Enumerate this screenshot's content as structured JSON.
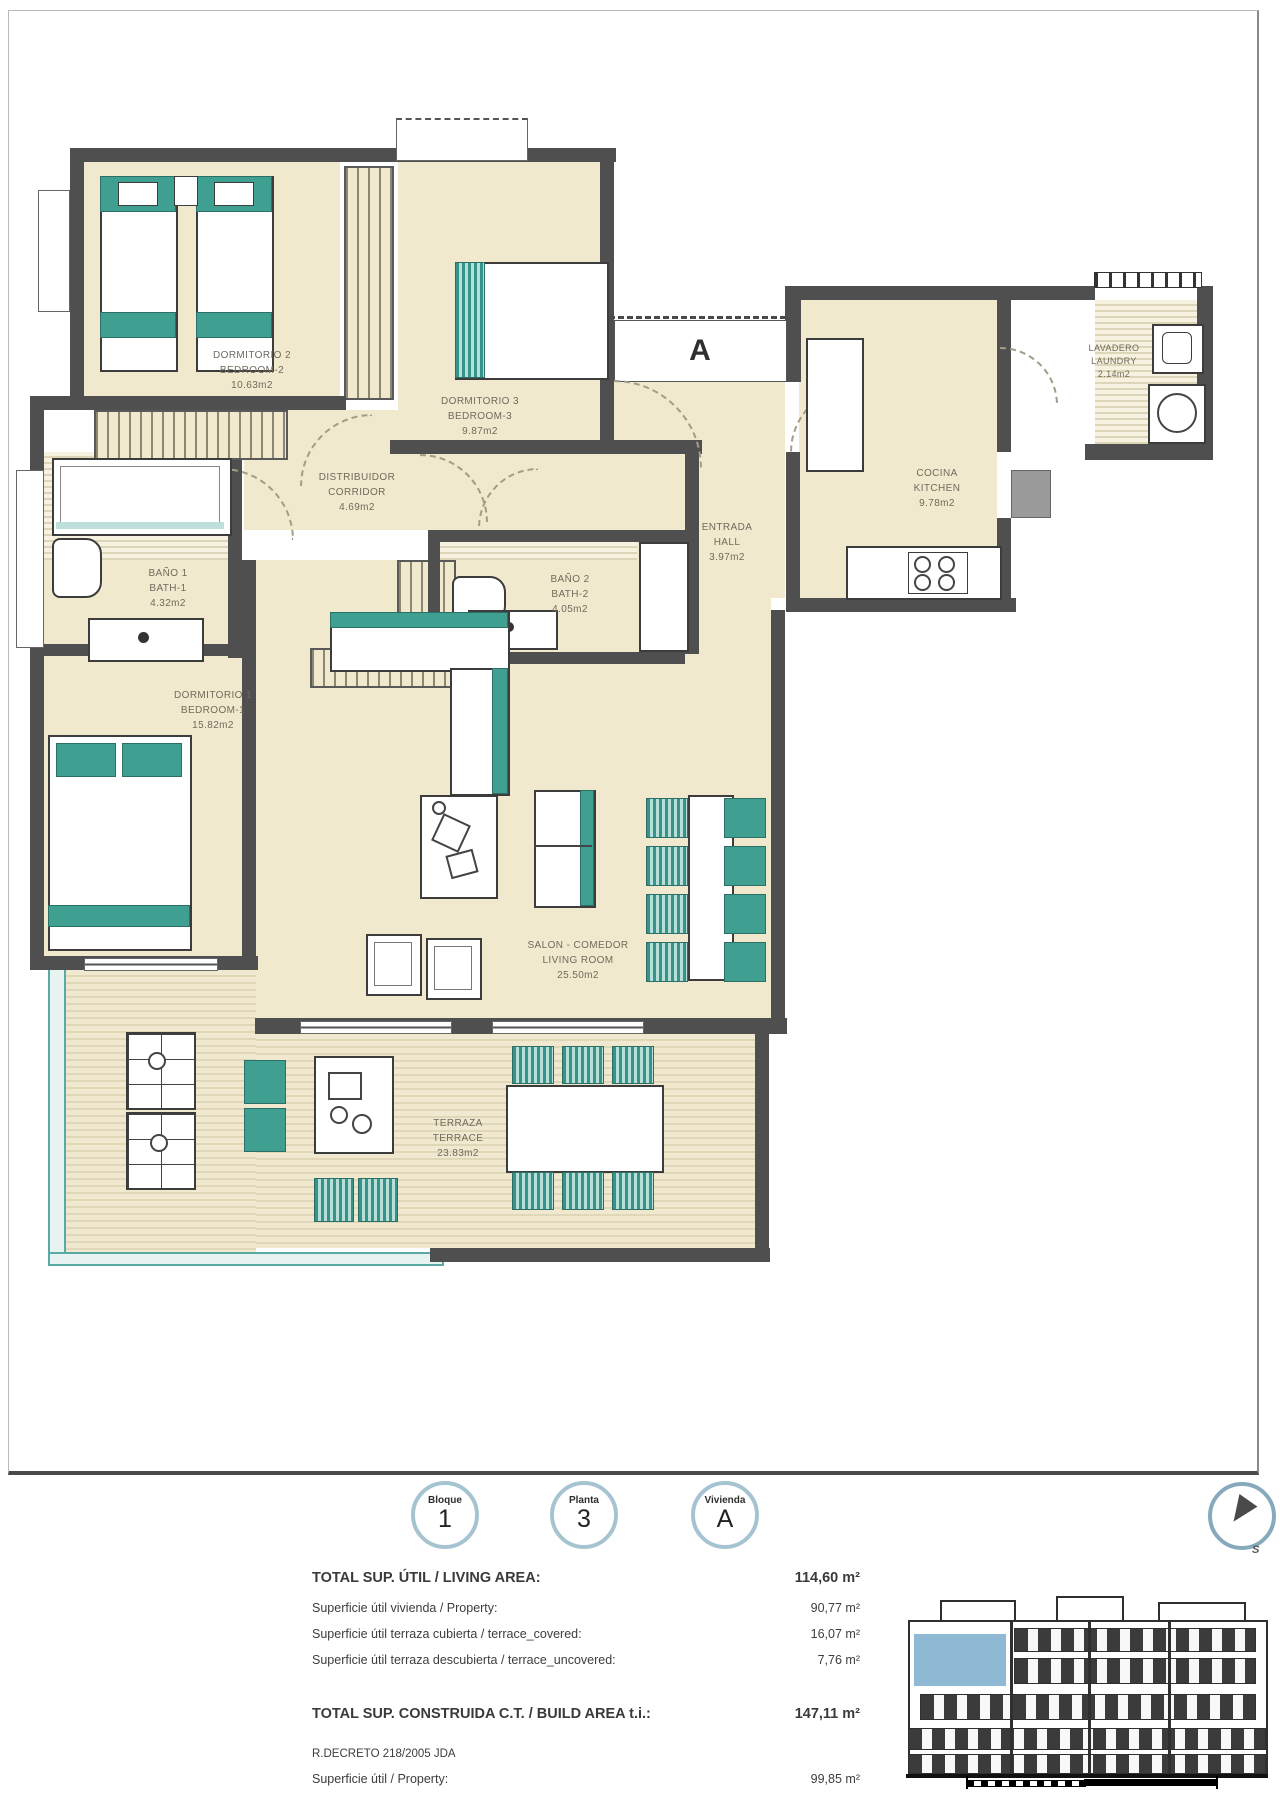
{
  "plan": {
    "entrance_label": "A",
    "rooms": [
      {
        "id": "bedroom2",
        "name_es": "DORMITORIO 2",
        "name_en": "BEDROOM-2",
        "area": "10.63m2"
      },
      {
        "id": "bedroom3",
        "name_es": "DORMITORIO 3",
        "name_en": "BEDROOM-3",
        "area": "9.87m2"
      },
      {
        "id": "corridor",
        "name_es": "DISTRIBUIDOR",
        "name_en": "CORRIDOR",
        "area": "4.69m2"
      },
      {
        "id": "hall",
        "name_es": "ENTRADA",
        "name_en": "HALL",
        "area": "3.97m2"
      },
      {
        "id": "kitchen",
        "name_es": "COCINA",
        "name_en": "KITCHEN",
        "area": "9.78m2"
      },
      {
        "id": "laundry",
        "name_es": "LAVADERO",
        "name_en": "LAUNDRY",
        "area": "2.14m2"
      },
      {
        "id": "bath1",
        "name_es": "BAÑO 1",
        "name_en": "BATH-1",
        "area": "4.32m2"
      },
      {
        "id": "bath2",
        "name_es": "BAÑO 2",
        "name_en": "BATH-2",
        "area": "4.05m2"
      },
      {
        "id": "bedroom1",
        "name_es": "DORMITORIO 1",
        "name_en": "BEDROOM-1",
        "area": "15.82m2"
      },
      {
        "id": "living",
        "name_es": "SALON - COMEDOR",
        "name_en": "LIVING ROOM",
        "area": "25.50m2"
      },
      {
        "id": "terrace",
        "name_es": "TERRAZA",
        "name_en": "TERRACE",
        "area": "23.83m2"
      }
    ]
  },
  "footer": {
    "badges": [
      {
        "label": "Bloque",
        "value": "1"
      },
      {
        "label": "Planta",
        "value": "3"
      },
      {
        "label": "Vivienda",
        "value": "A"
      }
    ],
    "compass_letter": "S",
    "areas": [
      {
        "label": "TOTAL SUP. ÚTIL / LIVING AREA:",
        "value": "114,60 m²"
      },
      {
        "label": "Superficie útil vivienda / Property:",
        "value": "90,77 m²"
      },
      {
        "label": "Superficie útil terraza cubierta / terrace_covered:",
        "value": "16,07 m²"
      },
      {
        "label": "Superficie útil terraza descubierta / terrace_uncovered:",
        "value": "7,76 m²"
      }
    ],
    "build_area": {
      "label": "TOTAL SUP. CONSTRUIDA C.T. / BUILD AREA t.i.:",
      "value": "147,11 m²"
    },
    "decree": "R.DECRETO 218/2005 JDA",
    "decree_row": {
      "label": "Superficie útil / Property:",
      "value": "99,85 m²"
    }
  },
  "colors": {
    "wall": "#4f4f4f",
    "cream": "#f1e9cd",
    "teal": "#3f9f91",
    "highlight_blue": "#8fb9d2",
    "badge_ring": "#a6c3d2"
  }
}
